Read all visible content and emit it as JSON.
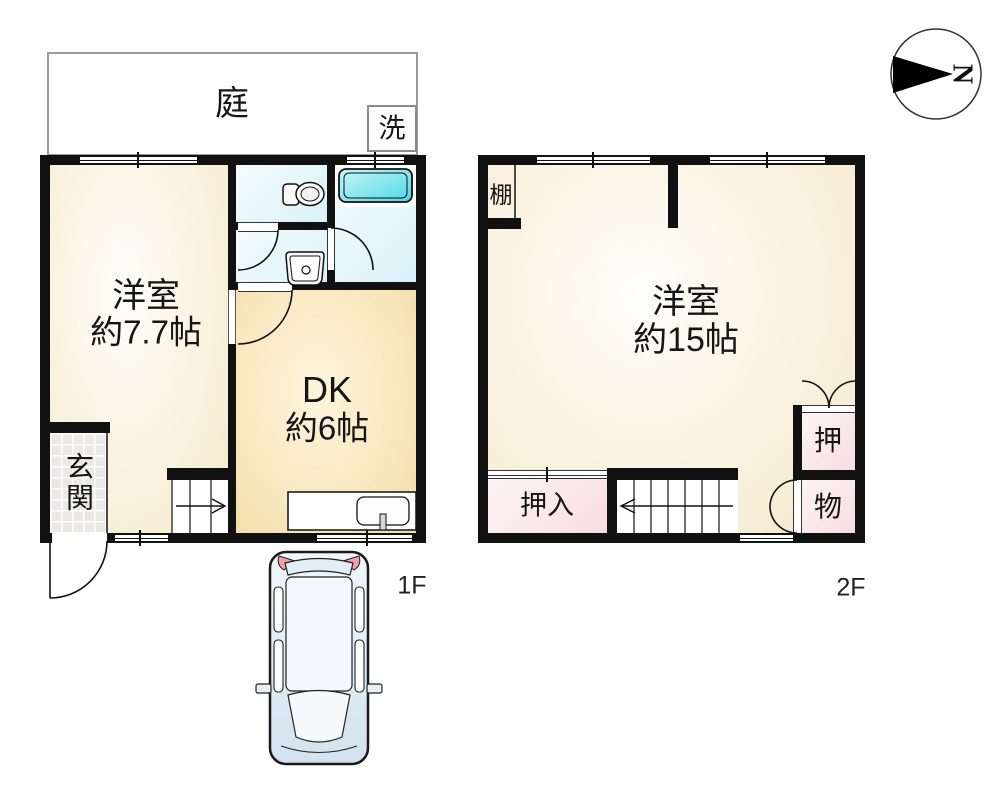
{
  "compass": {
    "north_label": "N"
  },
  "floor1": {
    "floor_label": "1F",
    "garden_label": "庭",
    "laundry_label": "洗",
    "western_room": {
      "name": "洋室",
      "size": "約7.7帖"
    },
    "dining_kitchen": {
      "name": "DK",
      "size": "約6帖"
    },
    "entrance_label": "玄関"
  },
  "floor2": {
    "floor_label": "2F",
    "shelf_label": "棚",
    "western_room": {
      "name": "洋室",
      "size": "約15帖"
    },
    "closet_label": "押入",
    "closet_upper_label": "押",
    "closet_lower_label": "物"
  },
  "icons": {
    "compass": "compass-north-arrow",
    "vehicle": "car-top-view"
  },
  "colors": {
    "wall": "#111111",
    "room_cream": "#f8eed6",
    "dk_tan": "#f6dfae",
    "wet_room_cyan": "#ddf2f8",
    "bathtub_cyan": "#4ed7e6",
    "closet_pink": "#f8dee3",
    "entrance_tile": "#ebe9e6",
    "outline_gray": "#9a9a9a",
    "car_blue": "#d3e2ee",
    "tail_light_red": "#f2a0a8"
  }
}
